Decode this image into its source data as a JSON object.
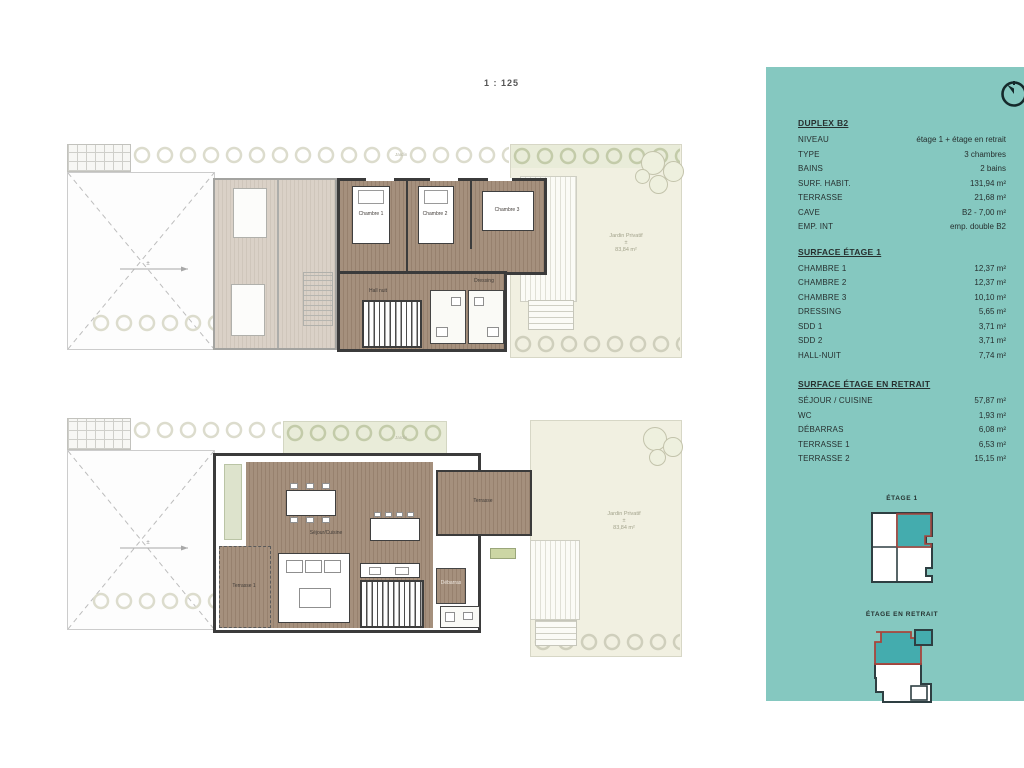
{
  "scale_label": "1 : 125",
  "panel": {
    "title": "DUPLEX B2",
    "info_rows": [
      {
        "label": "NIVEAU",
        "value": "étage 1 + étage en retrait"
      },
      {
        "label": "TYPE",
        "value": "3 chambres"
      },
      {
        "label": "BAINS",
        "value": "2 bains"
      },
      {
        "label": "SURF. HABIT.",
        "value": "131,94 m²"
      },
      {
        "label": "TERRASSE",
        "value": "21,68 m²"
      },
      {
        "label": "CAVE",
        "value": "B2 - 7,00 m²"
      },
      {
        "label": "EMP. INT",
        "value": "emp. double B2"
      }
    ],
    "sections": [
      {
        "title": "SURFACE ÉTAGE 1",
        "rows": [
          {
            "label": "CHAMBRE 1",
            "value": "12,37 m²"
          },
          {
            "label": "CHAMBRE 2",
            "value": "12,37 m²"
          },
          {
            "label": "CHAMBRE 3",
            "value": "10,10 m²"
          },
          {
            "label": "DRESSING",
            "value": "5,65 m²"
          },
          {
            "label": "SDD 1",
            "value": "3,71 m²"
          },
          {
            "label": "SDD 2",
            "value": "3,71 m²"
          },
          {
            "label": "HALL-NUIT",
            "value": "7,74 m²"
          }
        ]
      },
      {
        "title": "SURFACE ÉTAGE EN RETRAIT",
        "rows": [
          {
            "label": "SÉJOUR / CUISINE",
            "value": "57,87 m²"
          },
          {
            "label": "WC",
            "value": "1,93 m²"
          },
          {
            "label": "DÉBARRAS",
            "value": "6,08 m²"
          },
          {
            "label": "TERRASSE 1",
            "value": "6,53 m²"
          },
          {
            "label": "TERRASSE 2",
            "value": "15,15 m²"
          }
        ]
      }
    ],
    "keys": [
      {
        "label": "ÉTAGE 1"
      },
      {
        "label": "ÉTAGE EN RETRAIT"
      }
    ],
    "colors": {
      "panel_bg": "#85c8c0",
      "key_fill": "#44acae",
      "key_outline_red": "#a8453c",
      "key_outline_dark": "#2e3f42",
      "wall_dark": "#3b3b3b"
    }
  },
  "floor1": {
    "jardin_label": "Jardin",
    "dim_note": "±",
    "rooms": {
      "chambre1": "Chambre 1",
      "chambre2": "Chambre 2",
      "chambre3": "Chambre 3",
      "hall": "Hall nuit",
      "dressing": "Dressing"
    },
    "garden_label": {
      "line1": "Jardin Privatif",
      "line2": "±",
      "line3": "83,84 m²"
    }
  },
  "floor2": {
    "jardin_label": "Jardin",
    "dim_note": "±",
    "rooms": {
      "sejour": "Séjour/Cuisine",
      "terrasse2": "Terrasse",
      "terrasse1": "Terrasse 1",
      "debarras": "Débarras"
    },
    "garden_label": {
      "line1": "Jardin Privatif",
      "line2": "±",
      "line3": "83,84 m²"
    }
  }
}
